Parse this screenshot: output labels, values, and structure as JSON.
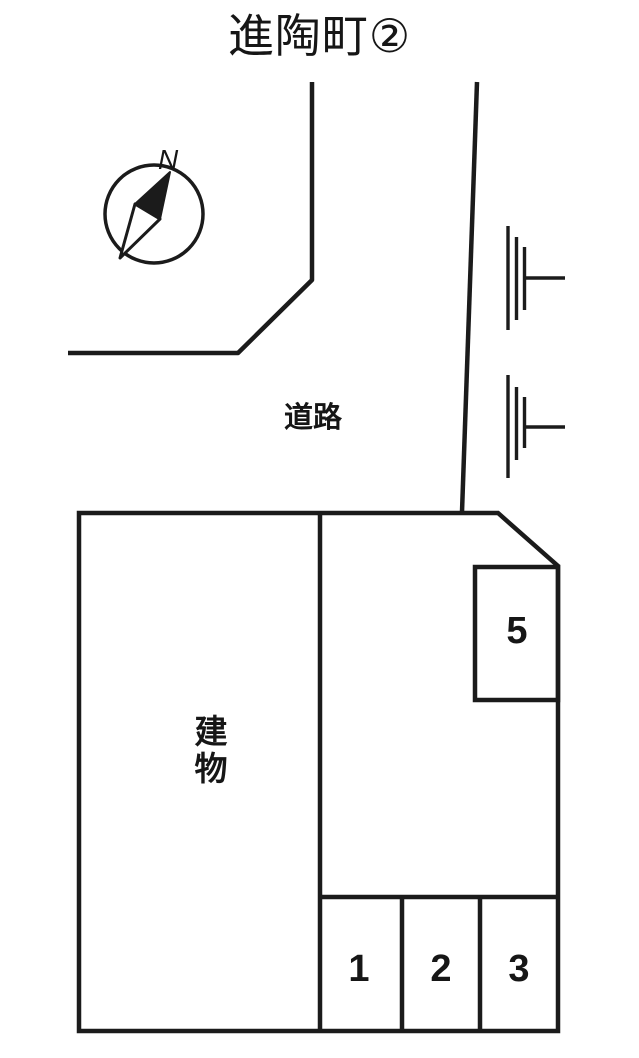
{
  "title": "進陶町②",
  "compass": {
    "north_label": "N",
    "icon": "compass-north-arrow-icon"
  },
  "road": {
    "label": "道路"
  },
  "building": {
    "label": "建物"
  },
  "parking": {
    "spaces": [
      {
        "number": "1"
      },
      {
        "number": "2"
      },
      {
        "number": "3"
      },
      {
        "number": "5"
      }
    ]
  },
  "map_symbols": {
    "pole_icon": "utility-pole-icon",
    "pole_count": 2
  },
  "colors": {
    "line": "#1b1b1b",
    "background": "#ffffff",
    "text": "#161616"
  }
}
